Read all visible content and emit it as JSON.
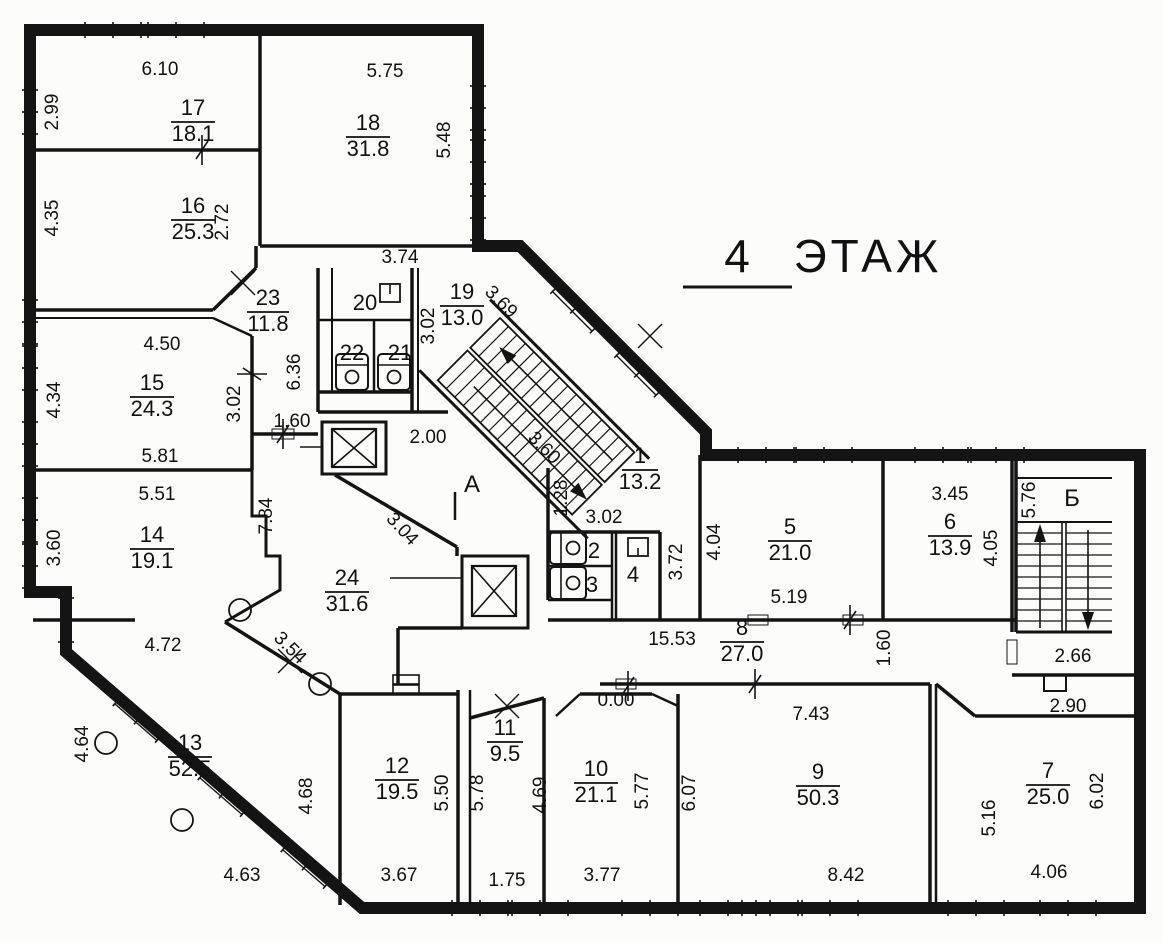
{
  "title": {
    "number": "4",
    "word": "ЭТАЖ"
  },
  "zones": {
    "vestibule": "A",
    "vestibule_tick": "I",
    "stairwell": "Б"
  },
  "rooms": {
    "r1": {
      "num": "1",
      "area": "13.2"
    },
    "r2": {
      "num": "2"
    },
    "r3": {
      "num": "3"
    },
    "r4": {
      "num": "4"
    },
    "r5": {
      "num": "5",
      "area": "21.0"
    },
    "r6": {
      "num": "6",
      "area": "13.9"
    },
    "r7": {
      "num": "7",
      "area": "25.0"
    },
    "r8": {
      "num": "8",
      "area": "27.0"
    },
    "r9": {
      "num": "9",
      "area": "50.3"
    },
    "r10": {
      "num": "10",
      "area": "21.1"
    },
    "r11": {
      "num": "11",
      "area": "9.5"
    },
    "r12": {
      "num": "12",
      "area": "19.5"
    },
    "r13": {
      "num": "13",
      "area": "52.5"
    },
    "r14": {
      "num": "14",
      "area": "19.1"
    },
    "r15": {
      "num": "15",
      "area": "24.3"
    },
    "r16": {
      "num": "16",
      "area": "25.3"
    },
    "r17": {
      "num": "17",
      "area": "18.1"
    },
    "r18": {
      "num": "18",
      "area": "31.8"
    },
    "r19": {
      "num": "19",
      "area": "13.0"
    },
    "r20": {
      "num": "20"
    },
    "r21": {
      "num": "21"
    },
    "r22": {
      "num": "22"
    },
    "r23": {
      "num": "23",
      "area": "11.8"
    },
    "r24": {
      "num": "24",
      "area": "31.6"
    }
  },
  "dims": {
    "d6_10": "6.10",
    "d2_99": "2.99",
    "d5_75": "5.75",
    "d5_48": "5.48",
    "d4_35": "4.35",
    "d2_72": "2.72",
    "d3_74": "3.74",
    "d4_50": "4.50",
    "d4_34": "4.34",
    "d3_02a": "3.02",
    "d1_60a": "1.60",
    "d5_81": "5.81",
    "d5_51": "5.51",
    "d7_84": "7.84",
    "d3_60a": "3.60",
    "d6_36": "6.36",
    "d3_02b": "3.02",
    "d3_69": "3.69",
    "d4_72": "4.72",
    "d3_54": "3.54",
    "d4_64": "4.64",
    "d4_68": "4.68",
    "d4_63": "4.63",
    "d2_00": "2.00",
    "d3_04": "3.04",
    "d3_60b": "3.60",
    "d1_28": "1.28",
    "d3_02c": "3.02",
    "d3_72": "3.72",
    "d4_04": "4.04",
    "d5_19": "5.19",
    "d3_45": "3.45",
    "d4_05": "4.05",
    "d5_76": "5.76",
    "d15_53": "15.53",
    "d1_60b": "1.60",
    "d2_66": "2.66",
    "d2_90": "2.90",
    "d0_00": "0.00",
    "d7_43": "7.43",
    "d6_07": "6.07",
    "d8_42": "8.42",
    "d5_16": "5.16",
    "d6_02": "6.02",
    "d4_06": "4.06",
    "d3_67": "3.67",
    "d5_50": "5.50",
    "d5_78": "5.78",
    "d1_75": "1.75",
    "d4_69": "4.69",
    "d5_77": "5.77",
    "d3_77": "3.77"
  }
}
